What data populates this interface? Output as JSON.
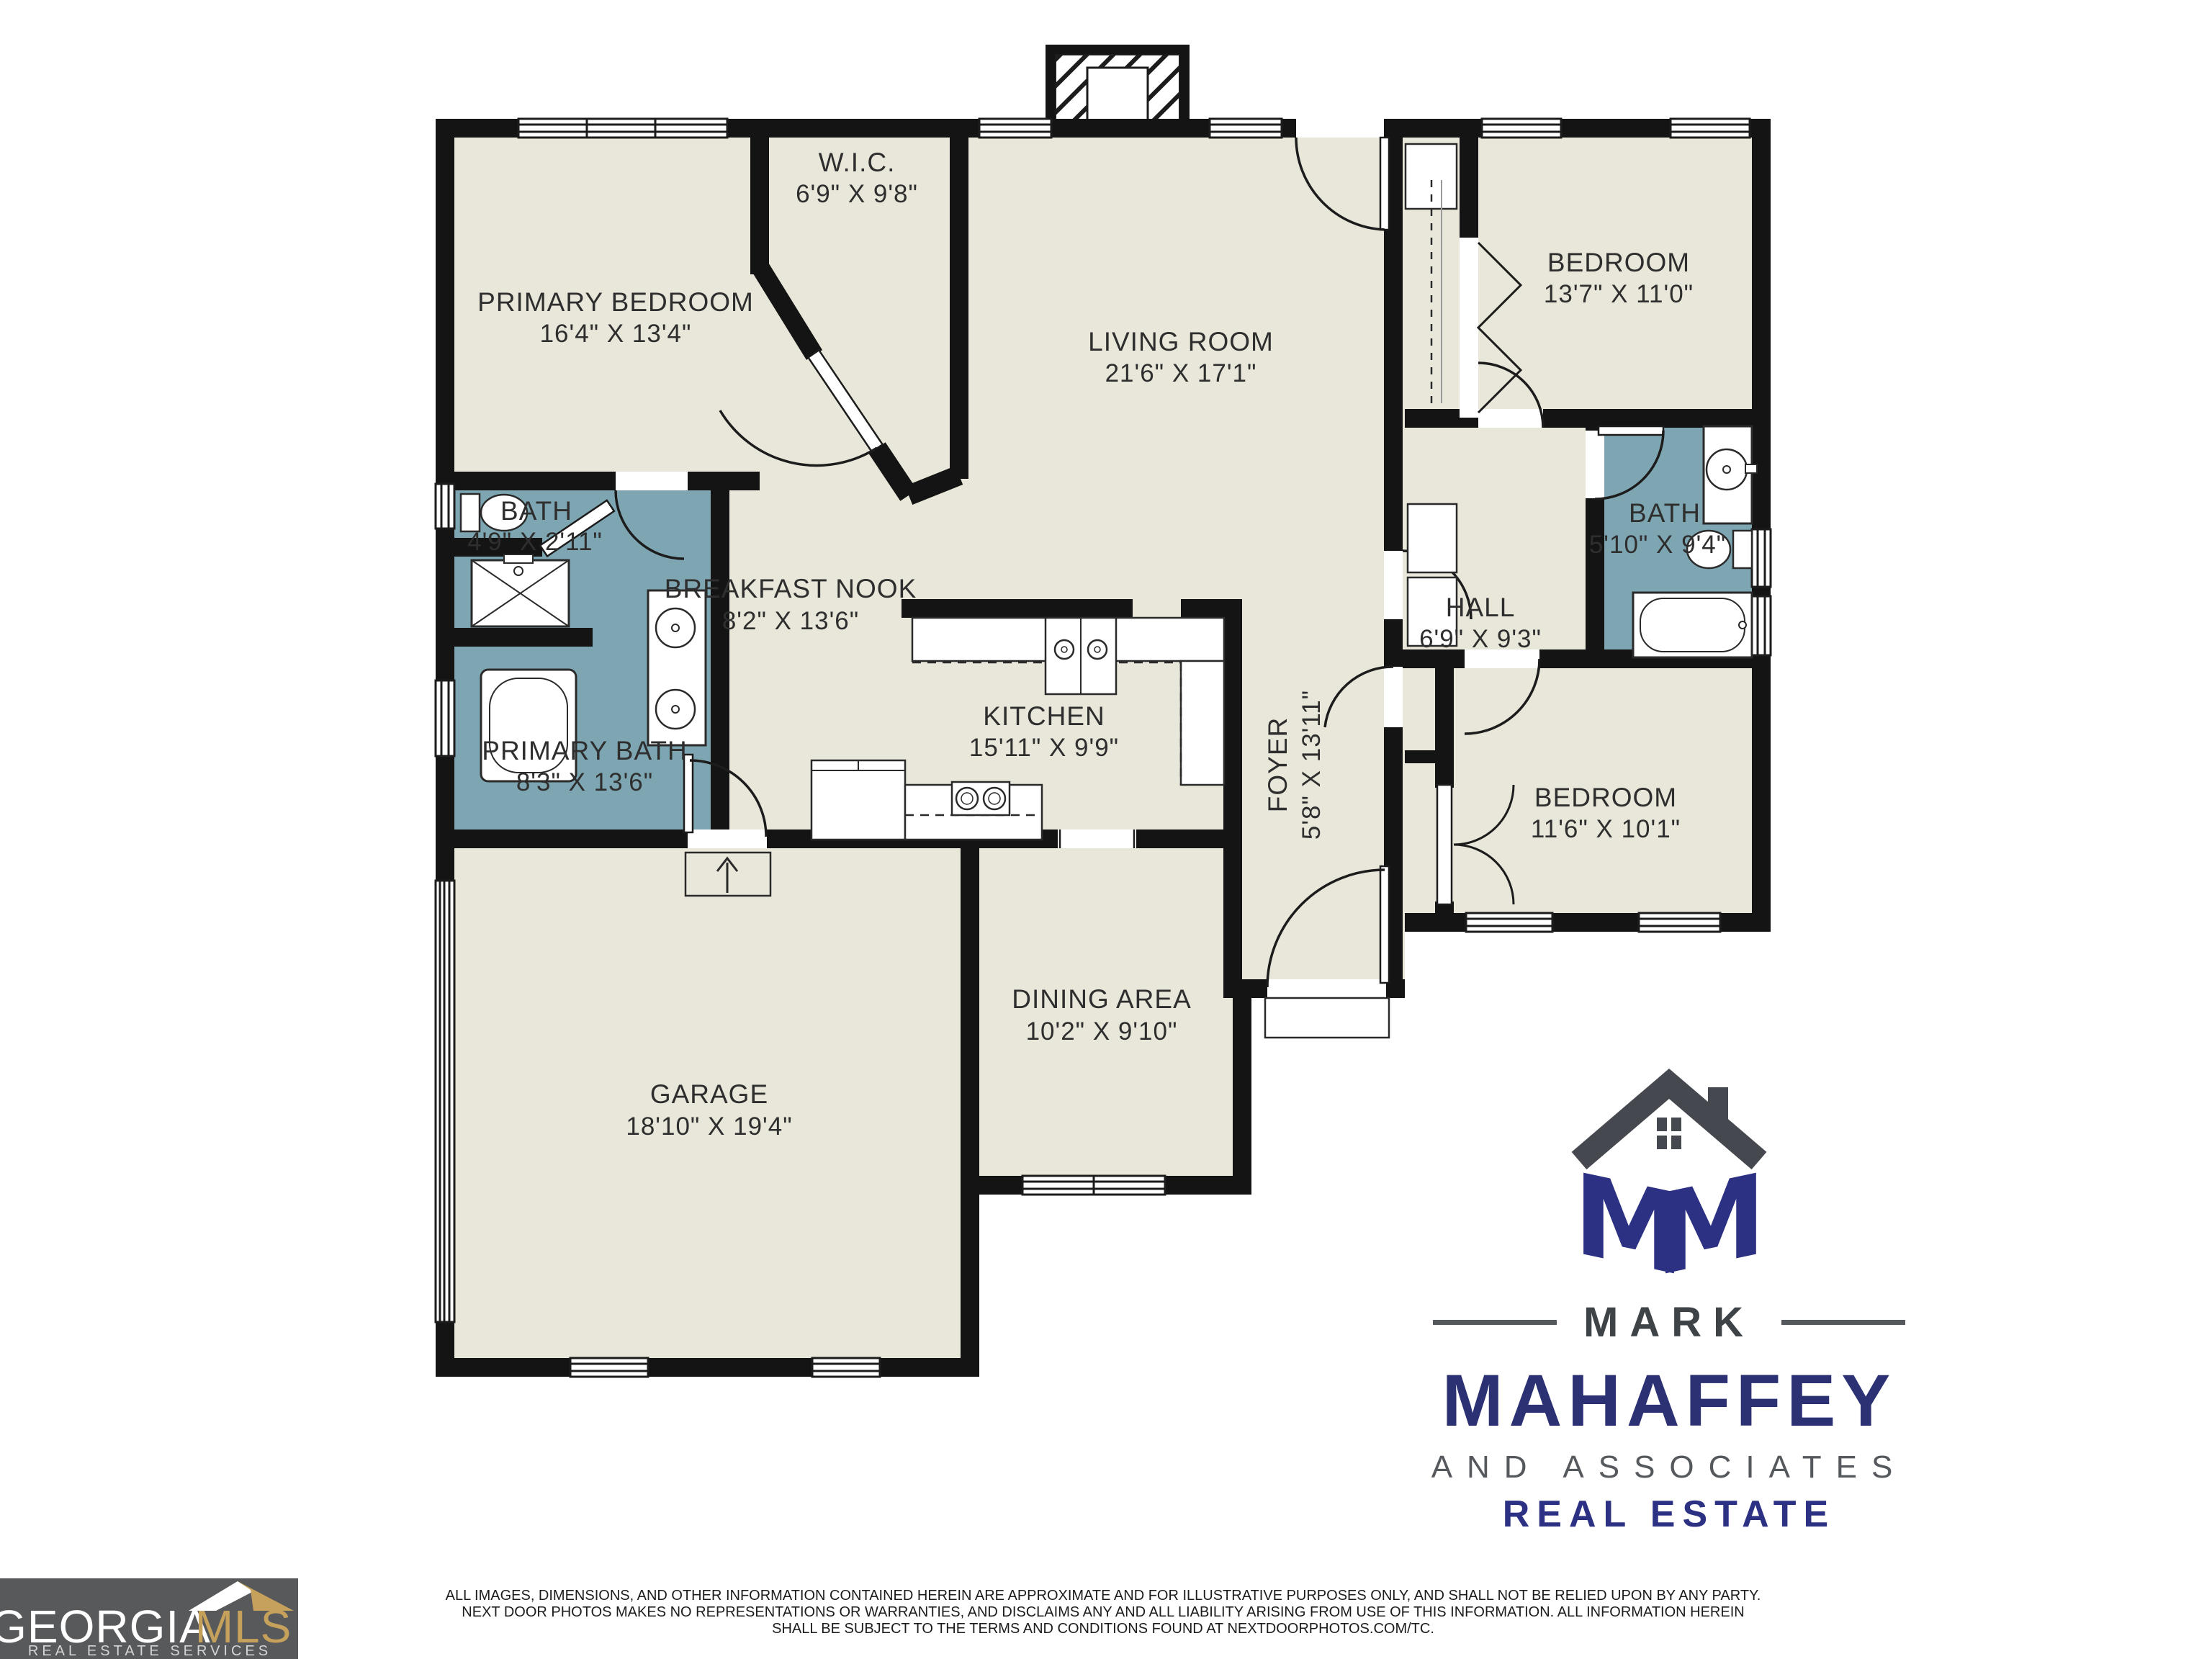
{
  "colors": {
    "room_fill": "#E9E7DA",
    "bath_fill": "#7EA6B2",
    "wall": "#141414",
    "brand_navy": "#2D3183",
    "brand_dark_gray": "#45494F",
    "brand_mid_gray": "#55585C",
    "mls_bg": "#58595B",
    "mls_gold": "#C6A15B"
  },
  "floor_plan": {
    "rooms": [
      {
        "name": "PRIMARY BEDROOM",
        "dims": "16'4\" X 13'4\""
      },
      {
        "name": "W.I.C.",
        "dims": "6'9\" X 9'8\""
      },
      {
        "name": "LIVING ROOM",
        "dims": "21'6\" X 17'1\""
      },
      {
        "name": "BEDROOM",
        "dims": "13'7\" X 11'0\""
      },
      {
        "name": "BATH",
        "dims": "5'10\" X 9'4\""
      },
      {
        "name": "HALL",
        "dims": "6'9\" X 9'3\""
      },
      {
        "name": "BEDROOM",
        "dims": "11'6\" X 10'1\""
      },
      {
        "name": "FOYER",
        "dims": "5'8\" X 13'11\""
      },
      {
        "name": "BREAKFAST NOOK",
        "dims": "8'2\" X 13'6\""
      },
      {
        "name": "KITCHEN",
        "dims": "15'11\" X 9'9\""
      },
      {
        "name": "BATH",
        "dims": "4'9\" X 2'11\""
      },
      {
        "name": "PRIMARY BATH",
        "dims": "8'3\" X 13'6\""
      },
      {
        "name": "DINING AREA",
        "dims": "10'2\" X 9'10\""
      },
      {
        "name": "GARAGE",
        "dims": "18'10\" X 19'4\""
      }
    ]
  },
  "branding": {
    "name_top": "MARK",
    "name_main": "MAHAFFEY",
    "tagline": "AND ASSOCIATES",
    "subtitle": "REAL ESTATE",
    "monogram_left": "M",
    "monogram_right": "M"
  },
  "mls": {
    "name_white": "GEORGIA",
    "name_gold": "MLS",
    "tagline": "REAL ESTATE SERVICES"
  },
  "disclaimer": {
    "line1": "ALL IMAGES, DIMENSIONS, AND OTHER INFORMATION CONTAINED HEREIN ARE APPROXIMATE AND FOR ILLUSTRATIVE PURPOSES ONLY, AND SHALL NOT BE RELIED UPON BY ANY PARTY.",
    "line2": "NEXT DOOR PHOTOS MAKES NO REPRESENTATIONS OR WARRANTIES, AND DISCLAIMS ANY AND ALL LIABILITY ARISING FROM USE OF THIS INFORMATION. ALL INFORMATION HEREIN",
    "line3": "SHALL BE SUBJECT TO THE TERMS AND CONDITIONS FOUND AT NEXTDOORPHOTOS.COM/TC."
  }
}
